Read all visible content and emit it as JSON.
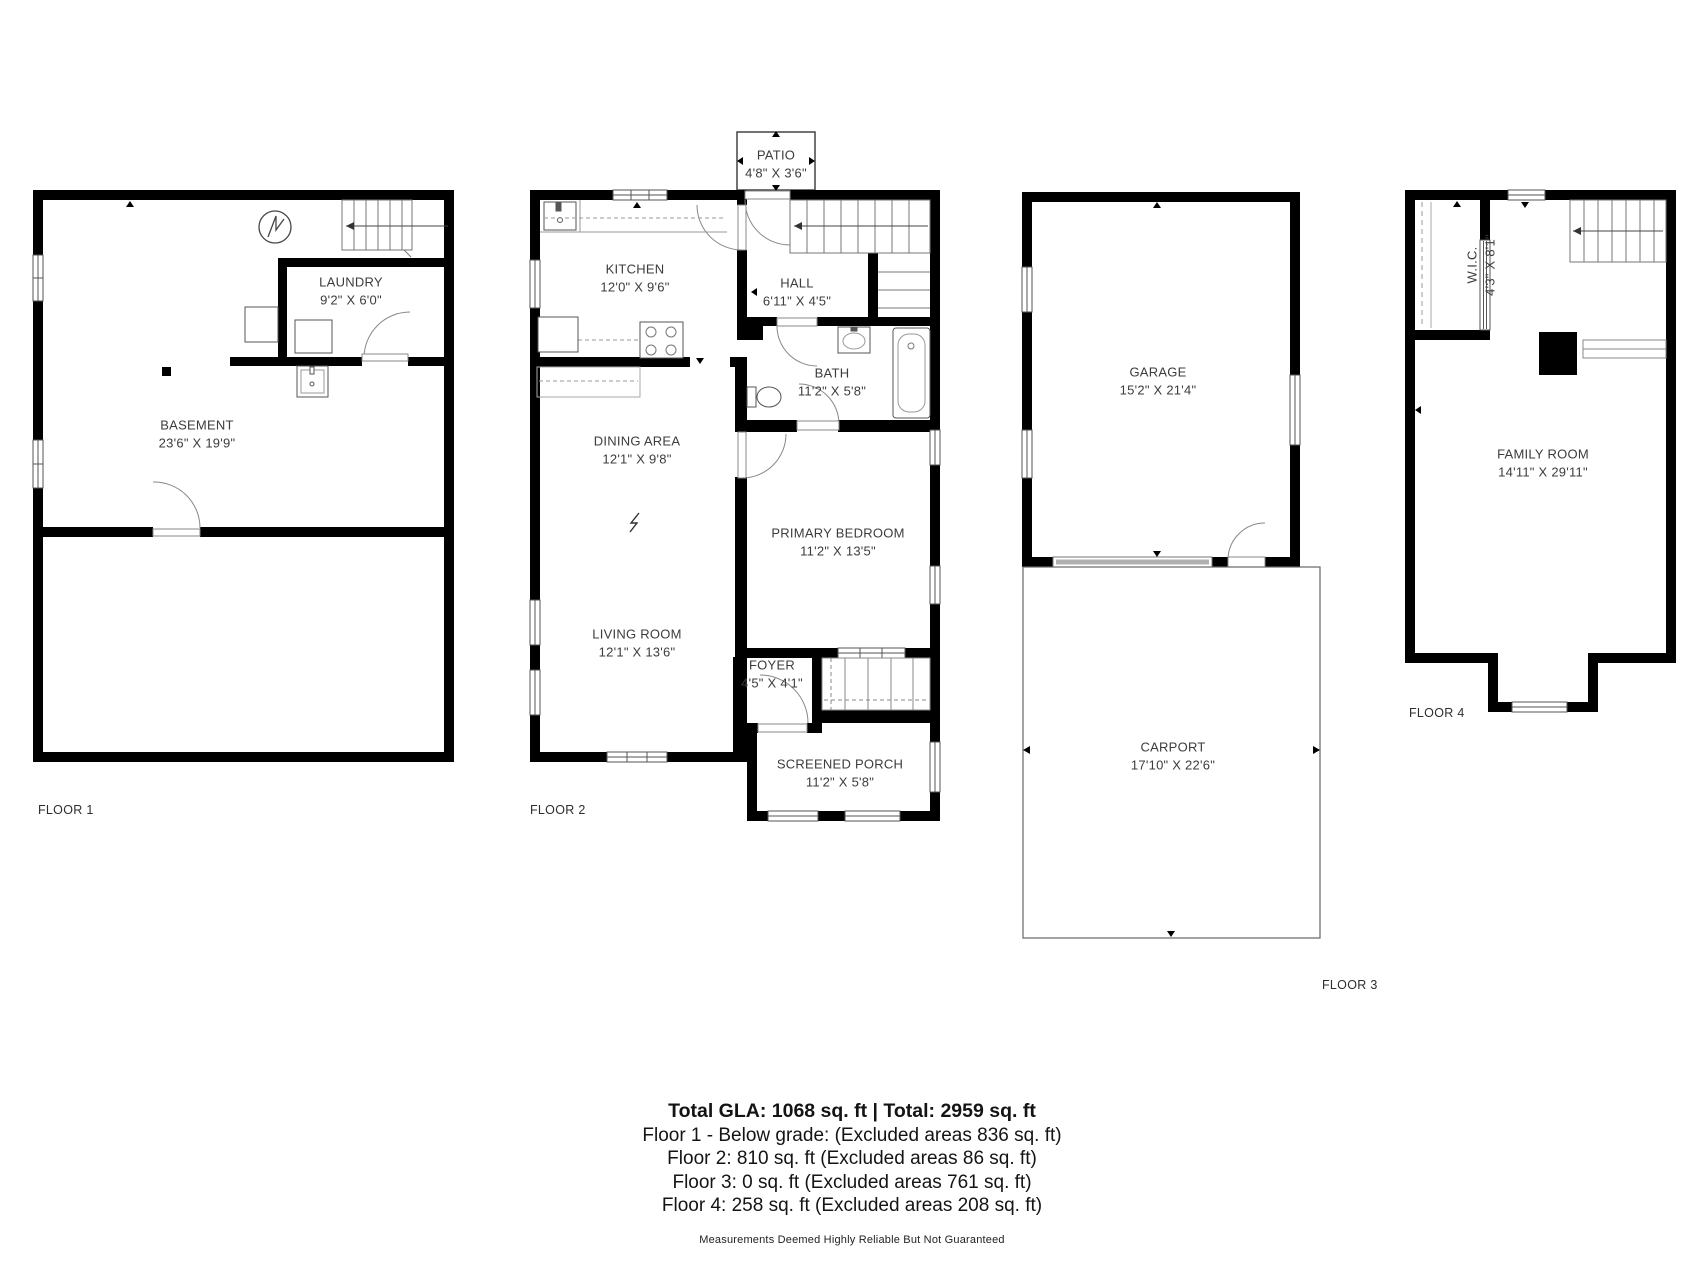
{
  "colors": {
    "walls": "#000000",
    "background": "#ffffff",
    "label_text": "#3c3c3c"
  },
  "floors": [
    {
      "label": "FLOOR 1",
      "rooms": [
        {
          "name": "BASEMENT",
          "dims": "23'6\" X 19'9\""
        },
        {
          "name": "LAUNDRY",
          "dims": "9'2\" X 6'0\""
        }
      ]
    },
    {
      "label": "FLOOR 2",
      "rooms": [
        {
          "name": "PATIO",
          "dims": "4'8\" X 3'6\""
        },
        {
          "name": "KITCHEN",
          "dims": "12'0\" X 9'6\""
        },
        {
          "name": "HALL",
          "dims": "6'11\" X 4'5\""
        },
        {
          "name": "BATH",
          "dims": "11'2\" X 5'8\""
        },
        {
          "name": "DINING AREA",
          "dims": "12'1\" X 9'8\""
        },
        {
          "name": "PRIMARY BEDROOM",
          "dims": "11'2\" X 13'5\""
        },
        {
          "name": "LIVING ROOM",
          "dims": "12'1\" X 13'6\""
        },
        {
          "name": "FOYER",
          "dims": "4'5\" X 4'1\""
        },
        {
          "name": "SCREENED PORCH",
          "dims": "11'2\" X 5'8\""
        }
      ]
    },
    {
      "label": "FLOOR 3",
      "rooms": [
        {
          "name": "GARAGE",
          "dims": "15'2\" X 21'4\""
        },
        {
          "name": "CARPORT",
          "dims": "17'10\" X 22'6\""
        }
      ]
    },
    {
      "label": "FLOOR 4",
      "rooms": [
        {
          "name": "W.I.C.",
          "dims": "4'3\" X 8'1\""
        },
        {
          "name": "FAMILY ROOM",
          "dims": "14'11\" X 29'11\""
        }
      ]
    }
  ],
  "fixtures": [
    "electrical-panel-icon",
    "washer-icon",
    "water-heater-icon",
    "utility-sink-icon",
    "kitchen-sink-icon",
    "stove-icon",
    "toilet-icon",
    "bath-sink-icon",
    "bathtub-icon",
    "stairs-icon",
    "garage-door-icon",
    "chimney-block",
    "closet-rod-icon"
  ],
  "summary": {
    "total": "Total GLA: 1068 sq. ft | Total: 2959 sq. ft",
    "lines": [
      "Floor 1 - Below grade: (Excluded areas 836 sq. ft)",
      "Floor 2: 810 sq. ft (Excluded areas 86 sq. ft)",
      "Floor 3: 0 sq. ft (Excluded areas 761 sq. ft)",
      "Floor 4: 258 sq. ft (Excluded areas 208 sq. ft)"
    ],
    "disclaimer": "Measurements Deemed Highly Reliable But Not Guaranteed"
  }
}
